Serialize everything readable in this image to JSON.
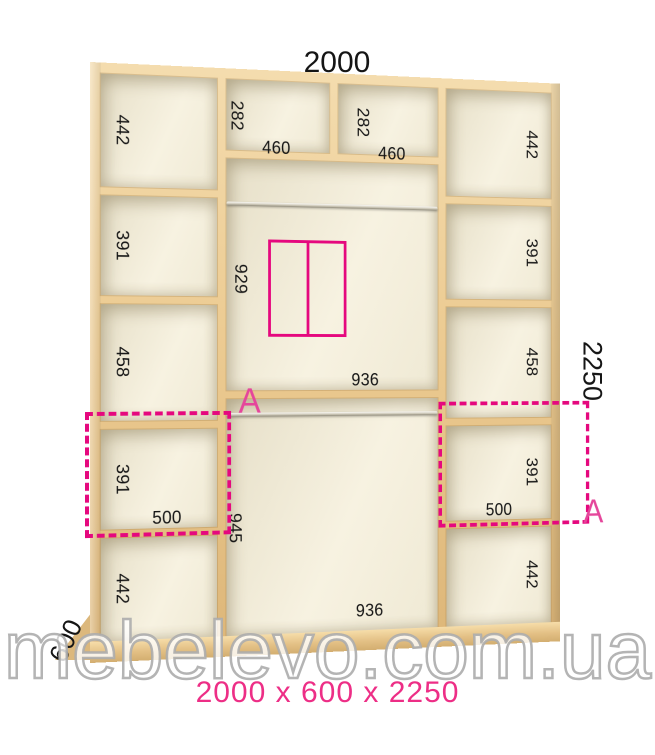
{
  "header": {
    "width_label": "2000"
  },
  "side": {
    "height_label": "2250",
    "depth_label": "600"
  },
  "cabinet": {
    "left_column": {
      "cells": [
        "442",
        "391",
        "458",
        "391",
        "442"
      ],
      "shelf_width": "500"
    },
    "right_column": {
      "cells": [
        "442",
        "391",
        "458",
        "391",
        "442"
      ],
      "shelf_width": "500"
    },
    "center_column": {
      "top_cells": [
        {
          "height": "282",
          "width": "460"
        },
        {
          "height": "282",
          "width": "460"
        }
      ],
      "middle_cell": {
        "height": "929",
        "width": "936"
      },
      "bottom_cell": {
        "height": "945",
        "width": "936"
      }
    },
    "section_marker": "A"
  },
  "footer": {
    "caption": "2000 x 600 x 2250",
    "watermark": "mebelevo.com.ua"
  },
  "colors": {
    "accent": "#e5087e",
    "caption_pink": "#ed2e86",
    "wood_light": "#f4dcae",
    "wood_dark": "#ddb678",
    "interior": "#f6f1df",
    "label_text": "#151515"
  }
}
